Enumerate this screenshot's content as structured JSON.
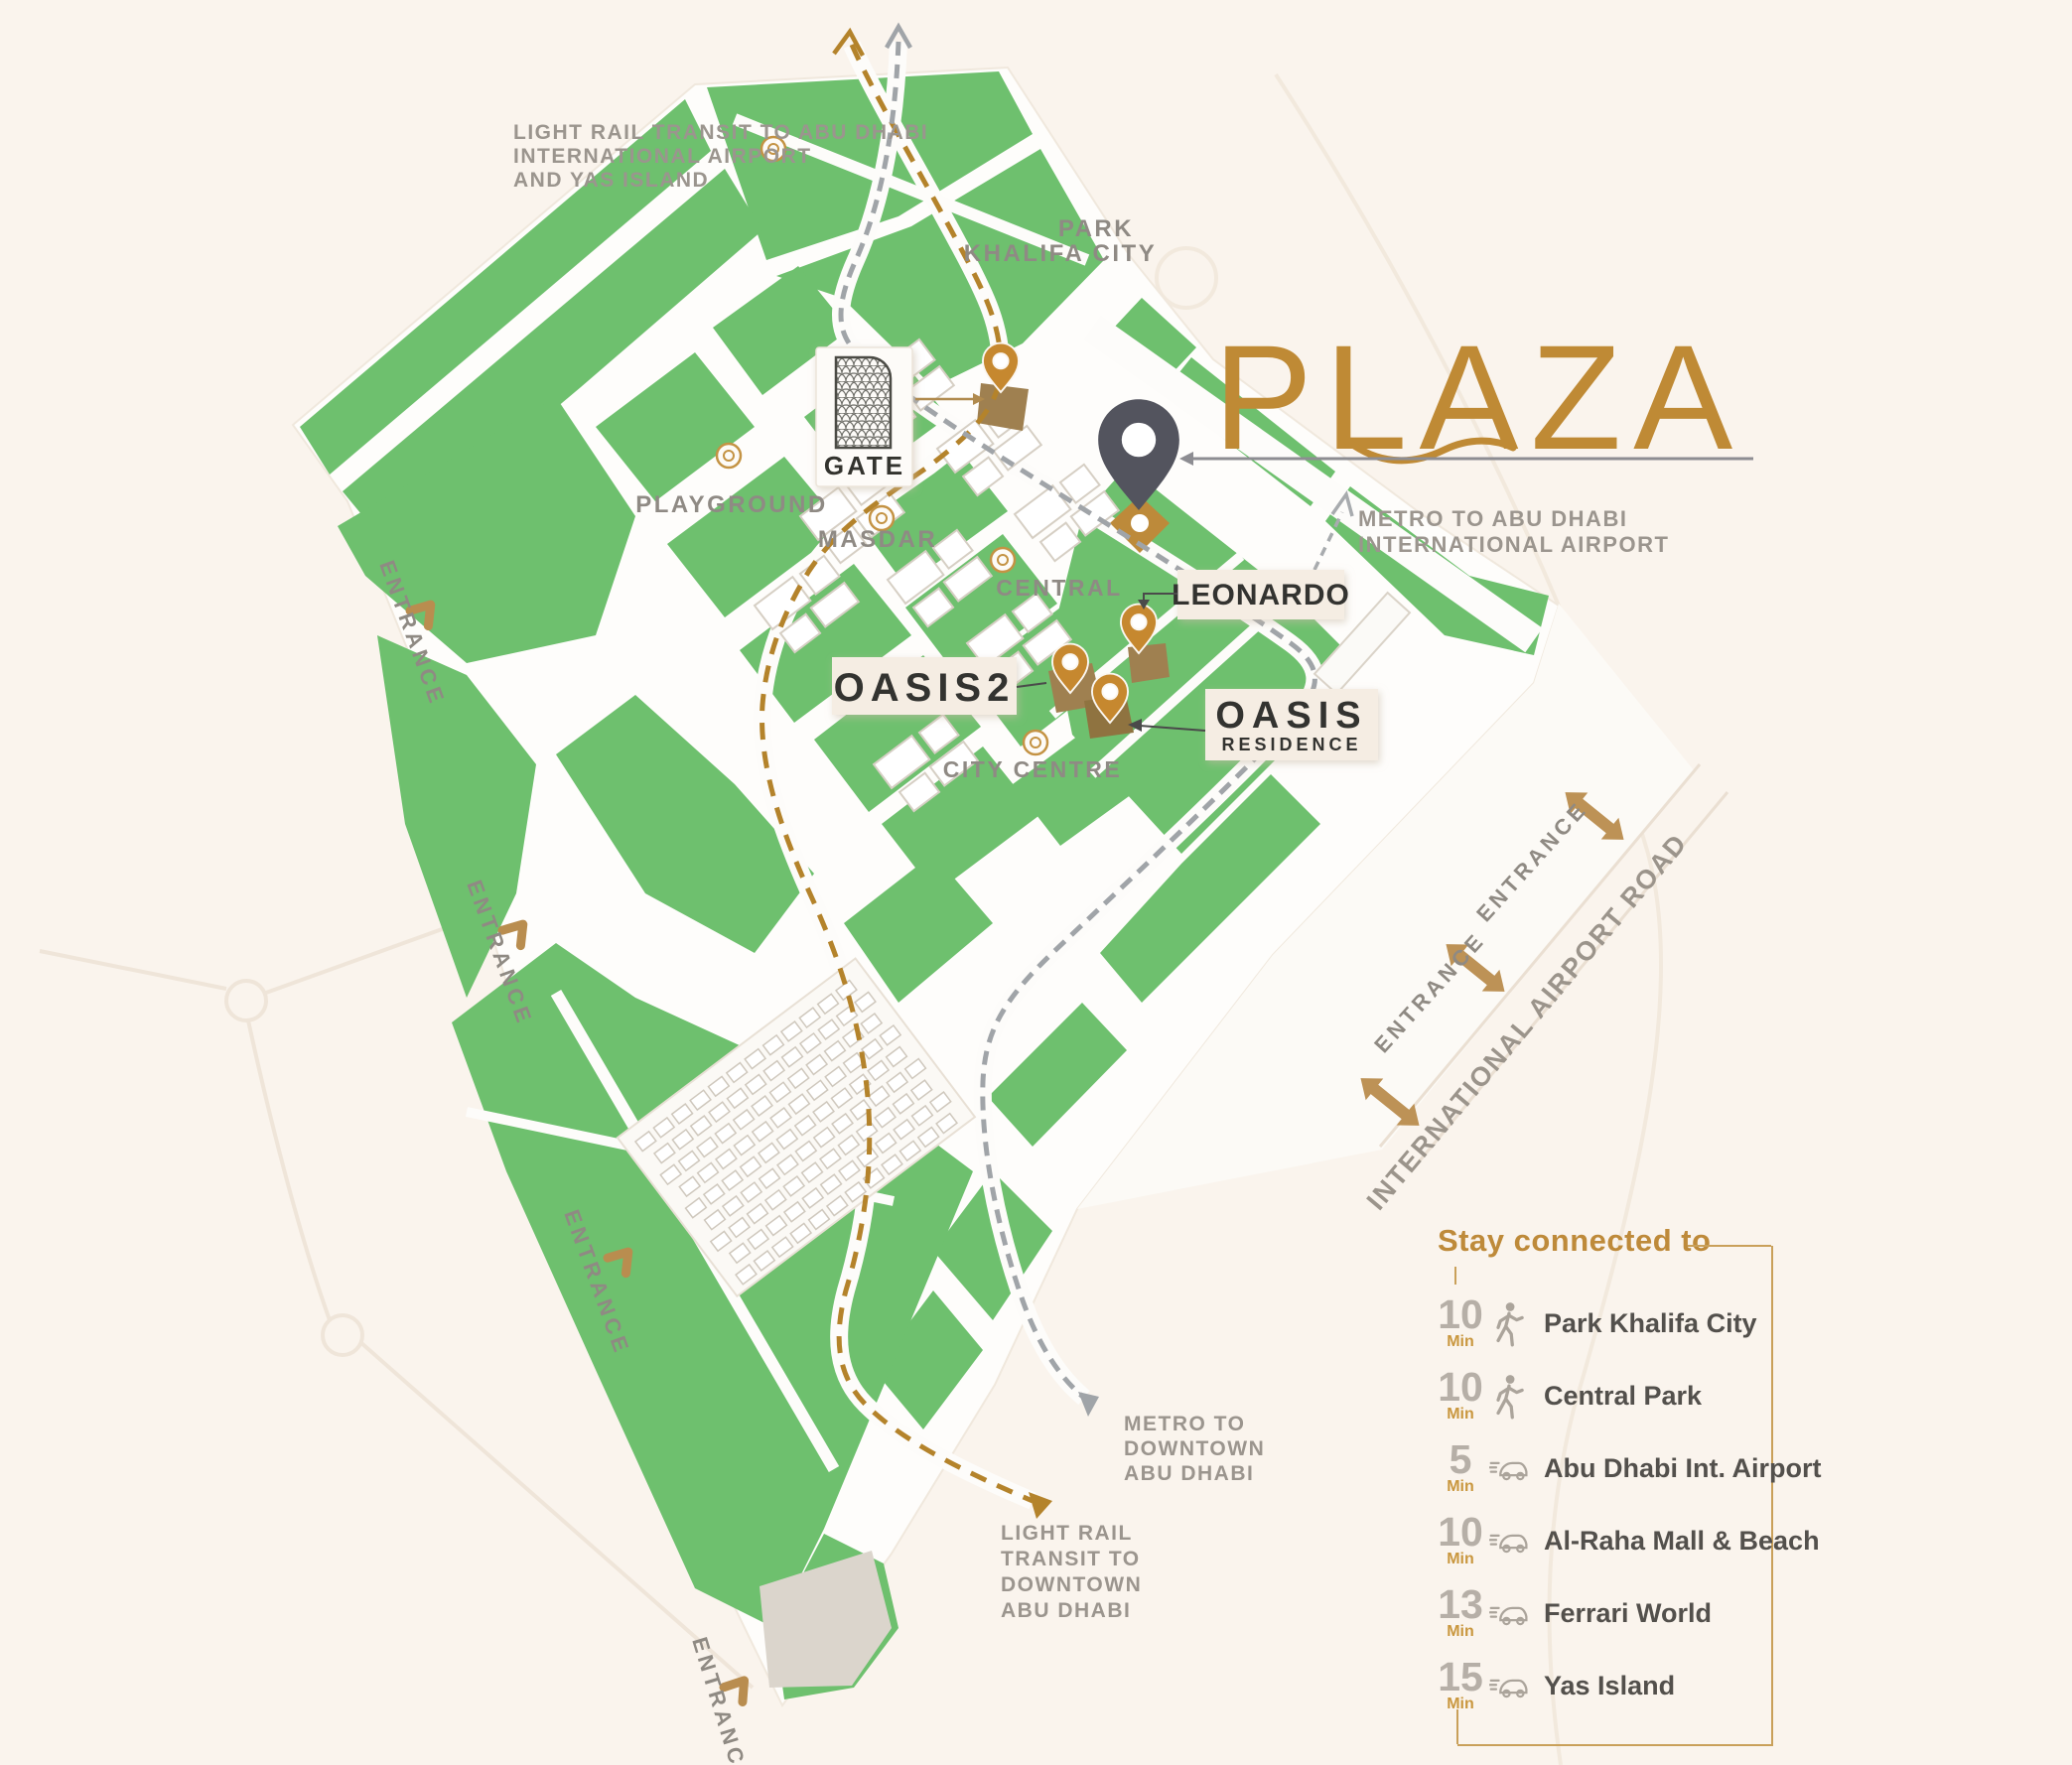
{
  "brand": {
    "plaza_title": "PLAZA"
  },
  "map": {
    "transit_notes": {
      "light_rail_north": [
        "LIGHT RAIL TRANSIT TO ABU DHABI",
        "INTERNATIONAL AIRPORT",
        "AND YAS ISLAND"
      ],
      "metro_airport": [
        "METRO TO ABU DHABI",
        "INTERNATIONAL AIRPORT"
      ],
      "metro_downtown": [
        "METRO TO",
        "DOWNTOWN",
        "ABU DHABI"
      ],
      "light_rail_downtown": [
        "LIGHT RAIL",
        "TRANSIT TO",
        "DOWNTOWN",
        "ABU DHABI"
      ]
    },
    "places": {
      "park_khalifa_line1": "PARK",
      "park_khalifa_line2": "KHALIFA CITY",
      "playground": "PLAYGROUND",
      "masdar": "MASDAR",
      "central": "CENTRAL",
      "city_centre": "CITY CENTRE"
    },
    "roads": {
      "airport_road": "INTERNATIONAL AIRPORT ROAD",
      "entrance": "ENTRANCE"
    },
    "projects": {
      "gate": "GATE",
      "oasis2": "OASIS2",
      "leonardo": "LEONARDO",
      "oasis": "OASIS",
      "oasis_residence_sub": "RESIDENCE"
    }
  },
  "connected": {
    "title": "Stay connected to",
    "items": [
      {
        "time": "10",
        "unit": "Min",
        "mode": "walk",
        "icon": "walking-person-icon",
        "label": "Park Khalifa City"
      },
      {
        "time": "10",
        "unit": "Min",
        "mode": "walk",
        "icon": "walking-person-icon",
        "label": "Central Park"
      },
      {
        "time": "5",
        "unit": "Min",
        "mode": "car",
        "icon": "car-icon",
        "label": "Abu Dhabi Int. Airport"
      },
      {
        "time": "10",
        "unit": "Min",
        "mode": "car",
        "icon": "car-icon",
        "label": "Al-Raha Mall & Beach"
      },
      {
        "time": "13",
        "unit": "Min",
        "mode": "car",
        "icon": "car-icon",
        "label": "Ferrari World"
      },
      {
        "time": "15",
        "unit": "Min",
        "mode": "car",
        "icon": "car-icon",
        "label": "Yas Island"
      }
    ]
  },
  "colors": {
    "background": "#FAF4ED",
    "map_green": "#6EC06E",
    "accent_gold": "#BF8A35",
    "pin_dark": "#54555E",
    "pin_gold": "#C6882F",
    "label_gray": "#8F8A84"
  }
}
